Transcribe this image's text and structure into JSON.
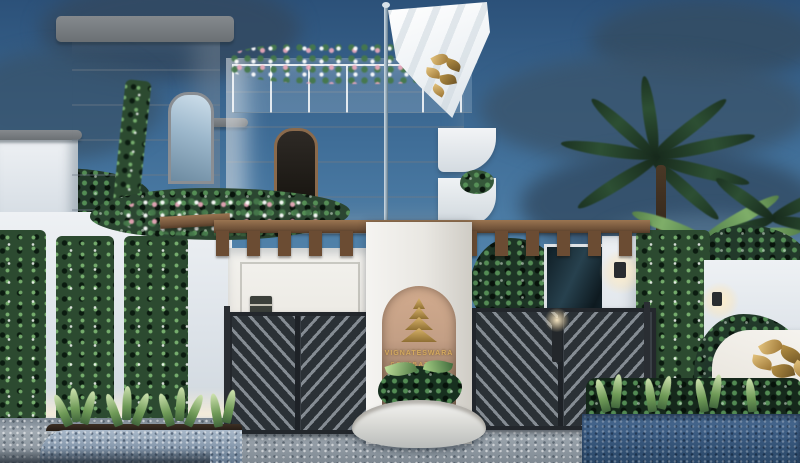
{
  "scene": {
    "type": "architectural rendering",
    "setting": "dusk exterior of a white gated villa community entrance",
    "elements": [
      "white villa with roof garden",
      "left tower block",
      "white flag with gold leaf emblem on pole",
      "wooden pergola over gate",
      "arched entrance monument sign",
      "metal chevron driveway gates",
      "vertical garden walls",
      "palm trees",
      "paved driveway",
      "corner monument sign"
    ]
  },
  "entrance_sign": {
    "logo": "gold-stacked-pyramid",
    "line1": "VIGNATESWARA",
    "line2": "COIMBATORE"
  },
  "corner_sign": {
    "logo": "gold-leaves",
    "line1": "WHISP",
    "line2": "OF EL"
  },
  "flag": {
    "cloth_color": "#f2f5f7",
    "emblem": "gold-leaves"
  },
  "palette": {
    "sky_top": "#2c5179",
    "sky_bottom": "#6f9dc0",
    "cloud": "#3d5a74",
    "wall_white": "#e9edf1",
    "wood": "#7d5c3e",
    "niche_tan": "#c39f85",
    "gold": "#c9a45a",
    "gate_metal": "#2b3136",
    "foliage_dark": "#22392a",
    "foliage_light": "#7fae69",
    "paving": "#99a3ac",
    "planter_blue": "#3a5a80"
  }
}
